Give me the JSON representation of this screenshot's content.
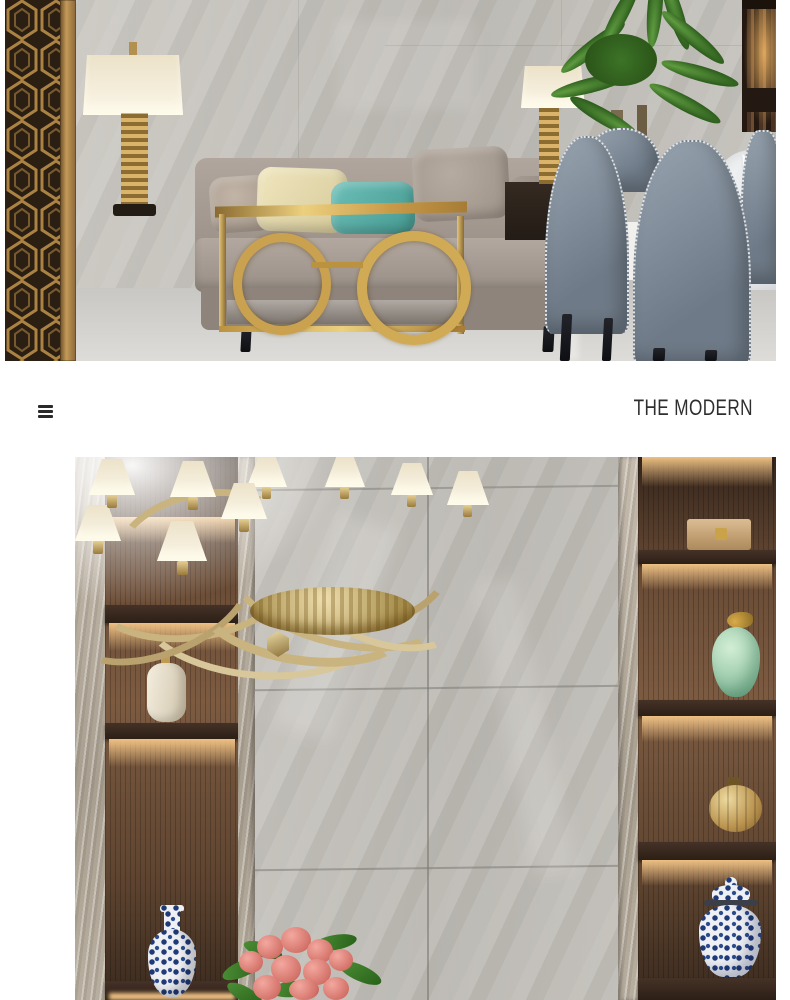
{
  "header": {
    "title": "THE MODERN",
    "title_color": "#2e2e2e",
    "menu_icon": "hamburger-icon"
  },
  "palette": {
    "page_bg": "#ffffff",
    "gold": "#c9a14f",
    "marble_light": "#cfccc6",
    "marble_dark": "#b3b0aa",
    "grout": "#807d77",
    "wood": "#5d4533",
    "shelf_glow": "#f8c989",
    "sofa_taupe": "#a69b92",
    "pillow_beige": "#b5a99c",
    "pillow_cream": "#eadfb2",
    "pillow_teal": "#58b1a9",
    "pillow_greige": "#aca196",
    "chair_blue_gray": "#7e8a97",
    "plant_green": "#4c7f31",
    "celadon": "#a9d6b4",
    "porcelain_blue": "#23407c",
    "flower_pink": "#e0837c",
    "screen_dark": "#150e08",
    "screen_gold": "#a87f3f"
  },
  "photos": {
    "top": {
      "description": "Living-dining room: gold laser-cut screen, cream table lamps with gold bases, gold console table with ring legs, taupe sofa with beige, cream, teal and greige pillows, palm plant, blue-gray studded dining chairs, round table with white cloth and folded napkin, grey marble tile wall and floor"
    },
    "bottom": {
      "description": "Feature wall: amber glass chandelier with cream shades, large grey marble wall tiles, lit walnut display niches holding a cream vase, blue-and-white porcelain vases, a celadon jar, a gold gourd and a tan box, pink flowers below"
    }
  }
}
